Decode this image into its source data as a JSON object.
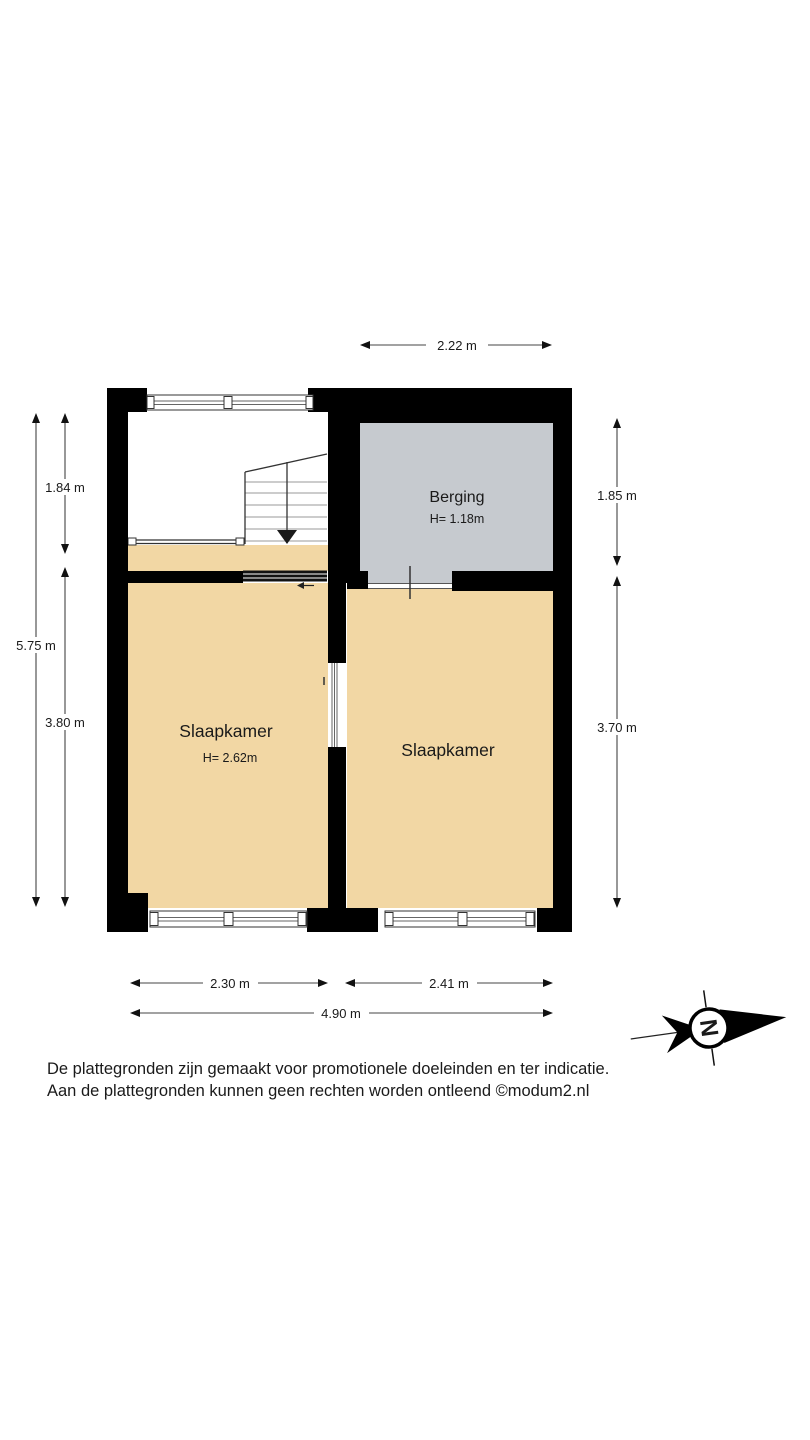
{
  "floorplan": {
    "colors": {
      "wall": "#000000",
      "bedroom_fill": "#F2D7A4",
      "berging_fill": "#C6CACF",
      "line": "#444444",
      "text": "#1A1A1A"
    },
    "rooms": [
      {
        "id": "berging",
        "label": "Berging",
        "height": "H= 1.18m"
      },
      {
        "id": "slaapkamer-left",
        "label": "Slaapkamer",
        "height": "H= 2.62m"
      },
      {
        "id": "slaapkamer-right",
        "label": "Slaapkamer"
      }
    ],
    "dimensions": [
      {
        "id": "top-berging-width",
        "label": "2.22 m"
      },
      {
        "id": "left-upper",
        "label": "1.84 m"
      },
      {
        "id": "left-total",
        "label": "5.75 m"
      },
      {
        "id": "left-lower",
        "label": "3.80 m"
      },
      {
        "id": "right-upper",
        "label": "1.85 m"
      },
      {
        "id": "right-lower",
        "label": "3.70 m"
      },
      {
        "id": "bottom-left",
        "label": "2.30 m"
      },
      {
        "id": "bottom-right",
        "label": "2.41 m"
      },
      {
        "id": "bottom-total",
        "label": "4.90 m"
      }
    ]
  },
  "compass": {
    "letter": "N"
  },
  "footer": {
    "line1": "De plattegronden zijn gemaakt voor promotionele doeleinden en ter indicatie.",
    "line2": "Aan de plattegronden kunnen geen rechten worden ontleend ©modum2.nl"
  }
}
